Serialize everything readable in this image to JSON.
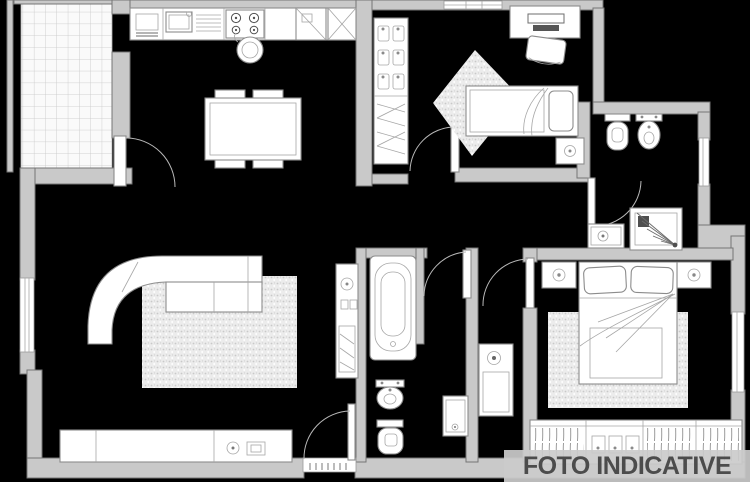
{
  "watermark": {
    "text": "FOTO INDICATIVE",
    "banner_color": "rgba(203,203,203,0.92)",
    "text_color": "#4c4c4c"
  },
  "canvas": {
    "width": 750,
    "height": 482,
    "background": "#000000"
  },
  "palette": {
    "wall_fill": "#c9c9c9",
    "wall_stroke": "#757575",
    "fixture_fill": "#ffffff",
    "fixture_stroke": "#8c8c8c",
    "rug_fill": "#ececec",
    "tile_line": "#c6c6c6"
  },
  "floorplan": {
    "type": "apartment-floor-plan",
    "rooms": [
      {
        "name": "balcony",
        "features": [
          "tiled-floor",
          "balcony-door"
        ]
      },
      {
        "name": "kitchen-living-room",
        "features": [
          "kitchen-counter",
          "sink",
          "stove",
          "tall-cabinets",
          "dining-table-4-chairs",
          "corner-sofa",
          "rug",
          "tv-sideboard",
          "stool"
        ]
      },
      {
        "name": "bedroom-2",
        "features": [
          "shelved-closet",
          "bed",
          "nightstand",
          "desk",
          "desk-chair",
          "diamond-rug",
          "window"
        ]
      },
      {
        "name": "bathroom-2",
        "features": [
          "toilet",
          "bidet",
          "shower",
          "washbasin",
          "window"
        ]
      },
      {
        "name": "bathroom-1",
        "features": [
          "bathtub",
          "bidet",
          "toilet",
          "washbasin",
          "laundry-column"
        ]
      },
      {
        "name": "hallway",
        "features": [
          "utility-cabinet",
          "entrance-door"
        ]
      },
      {
        "name": "master-bedroom",
        "features": [
          "double-bed",
          "two-nightstands",
          "rug",
          "fitted-wardrobe",
          "window"
        ]
      }
    ],
    "doors": [
      "entrance-door",
      "balcony-door",
      "bedroom-2-door",
      "bathroom-1-door",
      "bathroom-2-door",
      "master-bedroom-door"
    ],
    "windows": [
      "living-room-window",
      "bedroom-2-window",
      "bathroom-2-window",
      "master-bedroom-window"
    ]
  }
}
